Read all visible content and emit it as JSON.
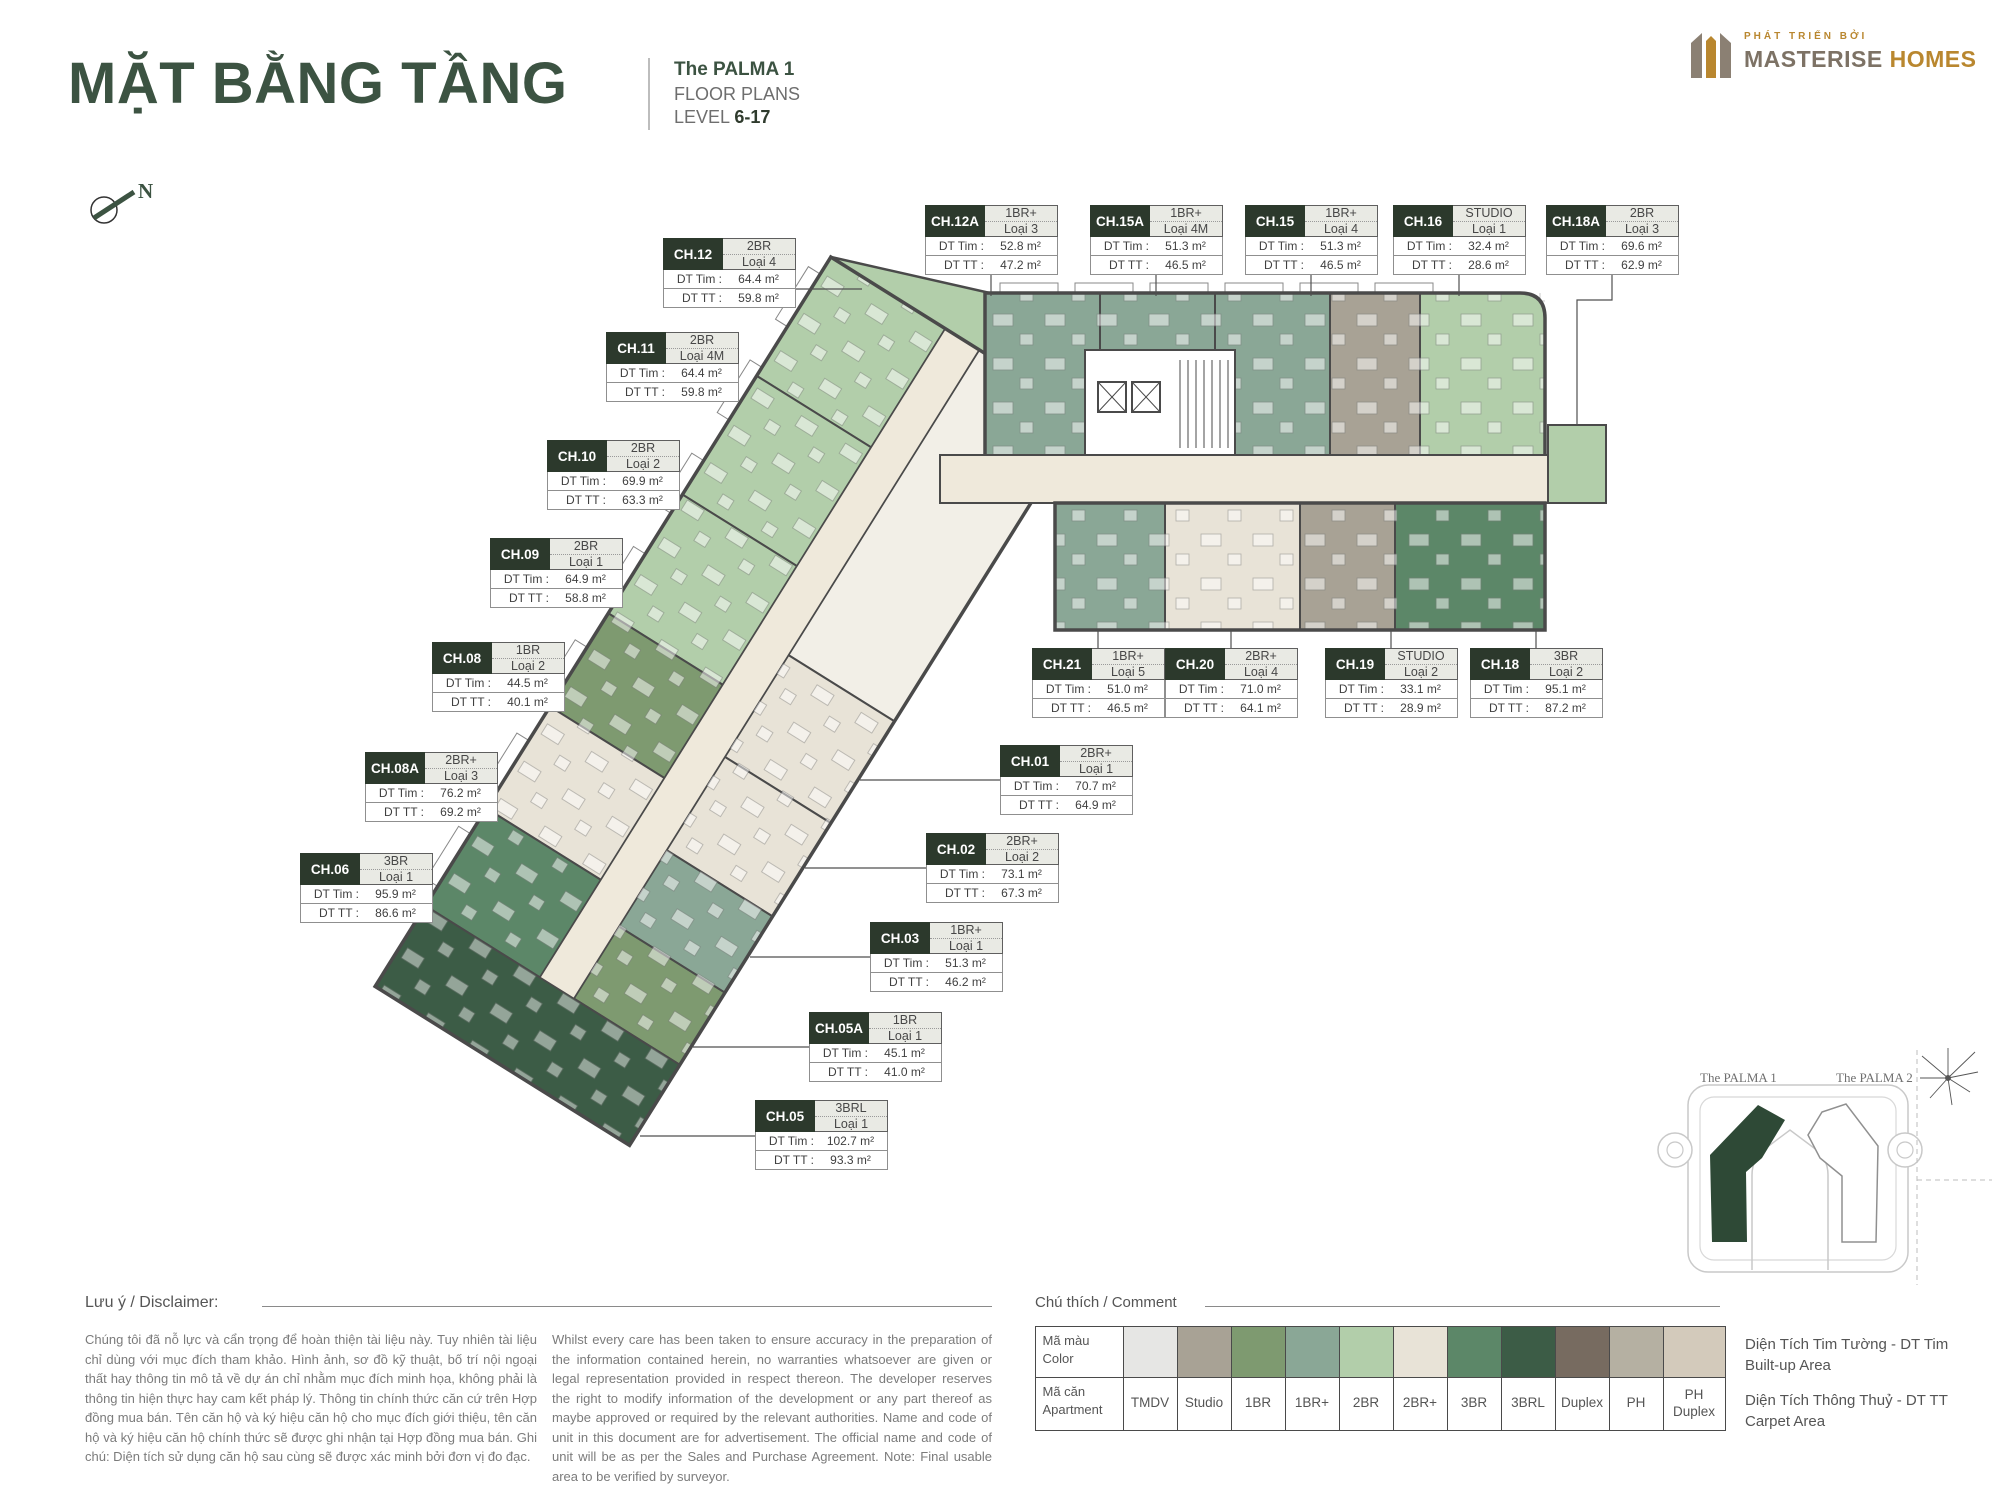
{
  "header": {
    "title": "MẶT BẰNG TẦNG",
    "project": "The PALMA 1",
    "subtitle": "FLOOR PLANS",
    "level_label": "LEVEL",
    "level_value": "6-17",
    "compass": "N"
  },
  "logo": {
    "tagline": "PHÁT TRIỂN BỞI",
    "brand_bold": "MASTERISE",
    "brand_accent": "HOMES"
  },
  "labels": {
    "dt_tim": "DT Tim :",
    "dt_tt": "DT TT :"
  },
  "units": [
    {
      "code": "CH.12",
      "type": "2BR",
      "loai": "Loại 4",
      "dt_tim": "64.4 m²",
      "dt_tt": "59.8 m²"
    },
    {
      "code": "CH.11",
      "type": "2BR",
      "loai": "Loại 4M",
      "dt_tim": "64.4 m²",
      "dt_tt": "59.8 m²"
    },
    {
      "code": "CH.10",
      "type": "2BR",
      "loai": "Loại 2",
      "dt_tim": "69.9 m²",
      "dt_tt": "63.3 m²"
    },
    {
      "code": "CH.09",
      "type": "2BR",
      "loai": "Loại 1",
      "dt_tim": "64.9 m²",
      "dt_tt": "58.8 m²"
    },
    {
      "code": "CH.08",
      "type": "1BR",
      "loai": "Loại 2",
      "dt_tim": "44.5 m²",
      "dt_tt": "40.1 m²"
    },
    {
      "code": "CH.08A",
      "type": "2BR+",
      "loai": "Loại 3",
      "dt_tim": "76.2 m²",
      "dt_tt": "69.2 m²"
    },
    {
      "code": "CH.06",
      "type": "3BR",
      "loai": "Loại 1",
      "dt_tim": "95.9 m²",
      "dt_tt": "86.6 m²"
    },
    {
      "code": "CH.12A",
      "type": "1BR+",
      "loai": "Loại 3",
      "dt_tim": "52.8 m²",
      "dt_tt": "47.2 m²"
    },
    {
      "code": "CH.15A",
      "type": "1BR+",
      "loai": "Loại 4M",
      "dt_tim": "51.3 m²",
      "dt_tt": "46.5 m²"
    },
    {
      "code": "CH.15",
      "type": "1BR+",
      "loai": "Loại 4",
      "dt_tim": "51.3 m²",
      "dt_tt": "46.5 m²"
    },
    {
      "code": "CH.16",
      "type": "STUDIO",
      "loai": "Loại 1",
      "dt_tim": "32.4 m²",
      "dt_tt": "28.6 m²"
    },
    {
      "code": "CH.18A",
      "type": "2BR",
      "loai": "Loại 3",
      "dt_tim": "69.6 m²",
      "dt_tt": "62.9 m²"
    },
    {
      "code": "CH.21",
      "type": "1BR+",
      "loai": "Loại 5",
      "dt_tim": "51.0 m²",
      "dt_tt": "46.5 m²"
    },
    {
      "code": "CH.20",
      "type": "2BR+",
      "loai": "Loại 4",
      "dt_tim": "71.0 m²",
      "dt_tt": "64.1 m²"
    },
    {
      "code": "CH.19",
      "type": "STUDIO",
      "loai": "Loại 2",
      "dt_tim": "33.1 m²",
      "dt_tt": "28.9 m²"
    },
    {
      "code": "CH.18",
      "type": "3BR",
      "loai": "Loại 2",
      "dt_tim": "95.1 m²",
      "dt_tt": "87.2 m²"
    },
    {
      "code": "CH.01",
      "type": "2BR+",
      "loai": "Loại 1",
      "dt_tim": "70.7 m²",
      "dt_tt": "64.9 m²"
    },
    {
      "code": "CH.02",
      "type": "2BR+",
      "loai": "Loại 2",
      "dt_tim": "73.1 m²",
      "dt_tt": "67.3 m²"
    },
    {
      "code": "CH.03",
      "type": "1BR+",
      "loai": "Loại 1",
      "dt_tim": "51.3 m²",
      "dt_tt": "46.2 m²"
    },
    {
      "code": "CH.05A",
      "type": "1BR",
      "loai": "Loại 1",
      "dt_tim": "45.1 m²",
      "dt_tt": "41.0 m²"
    },
    {
      "code": "CH.05",
      "type": "3BRL",
      "loai": "Loại 1",
      "dt_tim": "102.7 m²",
      "dt_tt": "93.3 m²"
    }
  ],
  "minimap": {
    "building1": "The PALMA 1",
    "building2": "The PALMA 2"
  },
  "disclaimer": {
    "heading": "Lưu ý / Disclaimer:",
    "vi": "Chúng tôi đã nỗ lực và cẩn trọng để hoàn thiện tài liệu này. Tuy nhiên tài liệu chỉ dùng với mục đích tham khảo. Hình ảnh, sơ đồ kỹ thuật, bố trí nội ngoại thất hay thông tin mô tả về dự án chỉ nhằm mục đích minh họa, không phải là thông tin hiện thực hay cam kết pháp lý. Thông tin chính thức căn cứ trên Hợp đồng mua bán. Tên căn hộ và ký hiệu căn hộ cho mục đích giới thiệu, tên căn hộ và ký hiệu căn hộ chính thức sẽ được ghi nhận tại Hợp đồng mua bán. Ghi chú: Diện tích sử dụng căn hộ sau cùng sẽ được xác minh bởi đơn vị đo đạc.",
    "en": "Whilst every care has been taken to ensure accuracy in the preparation of the information contained herein, no warranties whatsoever are given or legal representation provided in respect thereon. The developer reserves the right to modify information of the development or any part thereof as maybe approved or required by the relevant authorities. Name and code of unit in this document are for advertisement. The official name and code of unit will be as per the Sales and Purchase Agreement. Note: Final usable area to be verified by surveyor."
  },
  "legend": {
    "heading": "Chú thích / Comment",
    "color_label_vi": "Mã màu",
    "color_label_en": "Color",
    "apt_label_vi": "Mã căn",
    "apt_label_en": "Apartment",
    "items": [
      {
        "label": "TMDV",
        "color": "#e6e6e4"
      },
      {
        "label": "Studio",
        "color": "#a8a295"
      },
      {
        "label": "1BR",
        "color": "#7e9a70"
      },
      {
        "label": "1BR+",
        "color": "#8aa796"
      },
      {
        "label": "2BR",
        "color": "#b2ceaa"
      },
      {
        "label": "2BR+",
        "color": "#e8e3d7"
      },
      {
        "label": "3BR",
        "color": "#5c8768"
      },
      {
        "label": "3BRL",
        "color": "#3c5c46"
      },
      {
        "label": "Duplex",
        "color": "#776b60"
      },
      {
        "label": "PH",
        "color": "#b5b0a2"
      },
      {
        "label": "PH Duplex",
        "color": "#d3cabb"
      }
    ],
    "area_tim_vi": "Diện Tích Tim Tường - DT Tim",
    "area_tim_en": "Built-up Area",
    "area_tt_vi": "Diện Tích Thông Thuỷ - DT TT",
    "area_tt_en": "Carpet Area"
  }
}
